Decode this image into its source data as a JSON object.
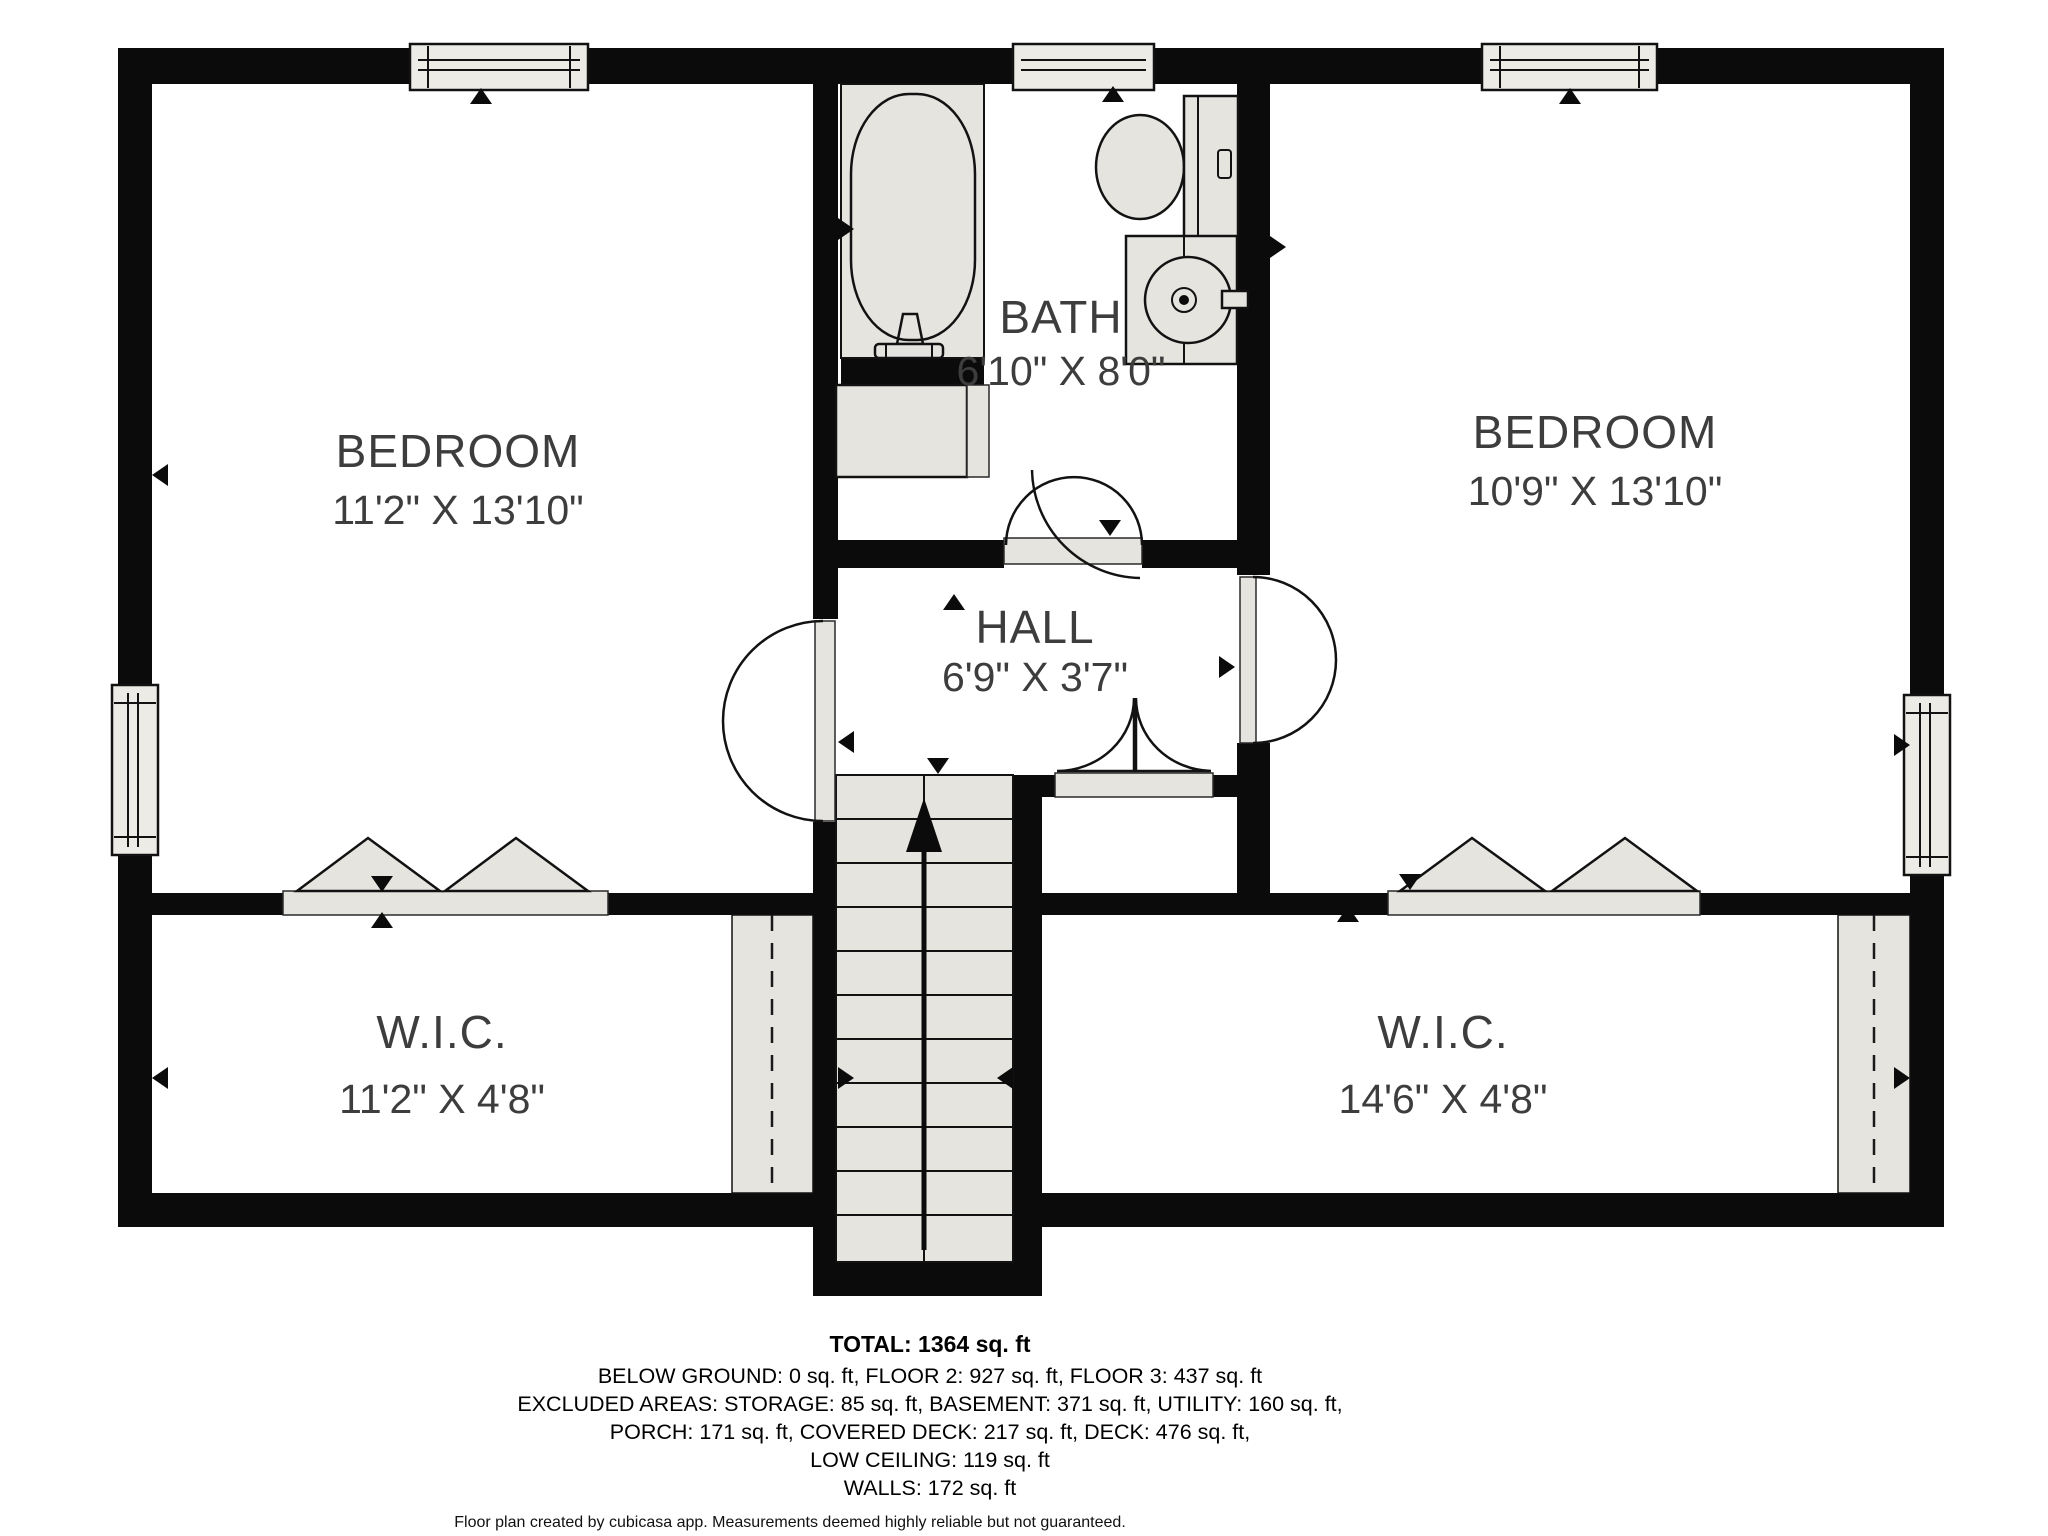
{
  "floorplan": {
    "rooms": [
      {
        "label": "BEDROOM",
        "dims": "11'2\" X 13'10\""
      },
      {
        "label": "BATH",
        "dims": "6'10\" X 8'0\""
      },
      {
        "label": "BEDROOM",
        "dims": "10'9\" X 13'10\""
      },
      {
        "label": "HALL",
        "dims": "6'9\" X 3'7\""
      },
      {
        "label": "W.I.C.",
        "dims": "11'2\" X 4'8\""
      },
      {
        "label": "W.I.C.",
        "dims": "14'6\" X 4'8\""
      }
    ],
    "summary": {
      "total": "TOTAL: 1364 sq. ft",
      "line2": "BELOW GROUND: 0 sq. ft, FLOOR 2: 927 sq. ft, FLOOR 3: 437 sq. ft",
      "line3": "EXCLUDED AREAS: STORAGE: 85 sq. ft, BASEMENT: 371 sq. ft, UTILITY: 160 sq. ft,",
      "line4": "PORCH: 171 sq. ft, COVERED DECK: 217 sq. ft, DECK: 476 sq. ft,",
      "line5": "LOW CEILING: 119 sq. ft",
      "line6": "WALLS: 172 sq. ft",
      "attribution": "Floor plan created by cubicasa app. Measurements deemed highly reliable but not guaranteed."
    },
    "colors": {
      "wall": "#0b0b0b",
      "fixture": "#e6e4df",
      "label_text": "#3d3d3d"
    },
    "icons": {
      "direction_marker": "small solid black triangle",
      "stairs_up_arrow": "vertical line with solid arrowhead",
      "window": "light gray bar with double glazing lines",
      "bifold_door": "triangle pair",
      "swing_door": "gray leaf with swing arc"
    }
  }
}
